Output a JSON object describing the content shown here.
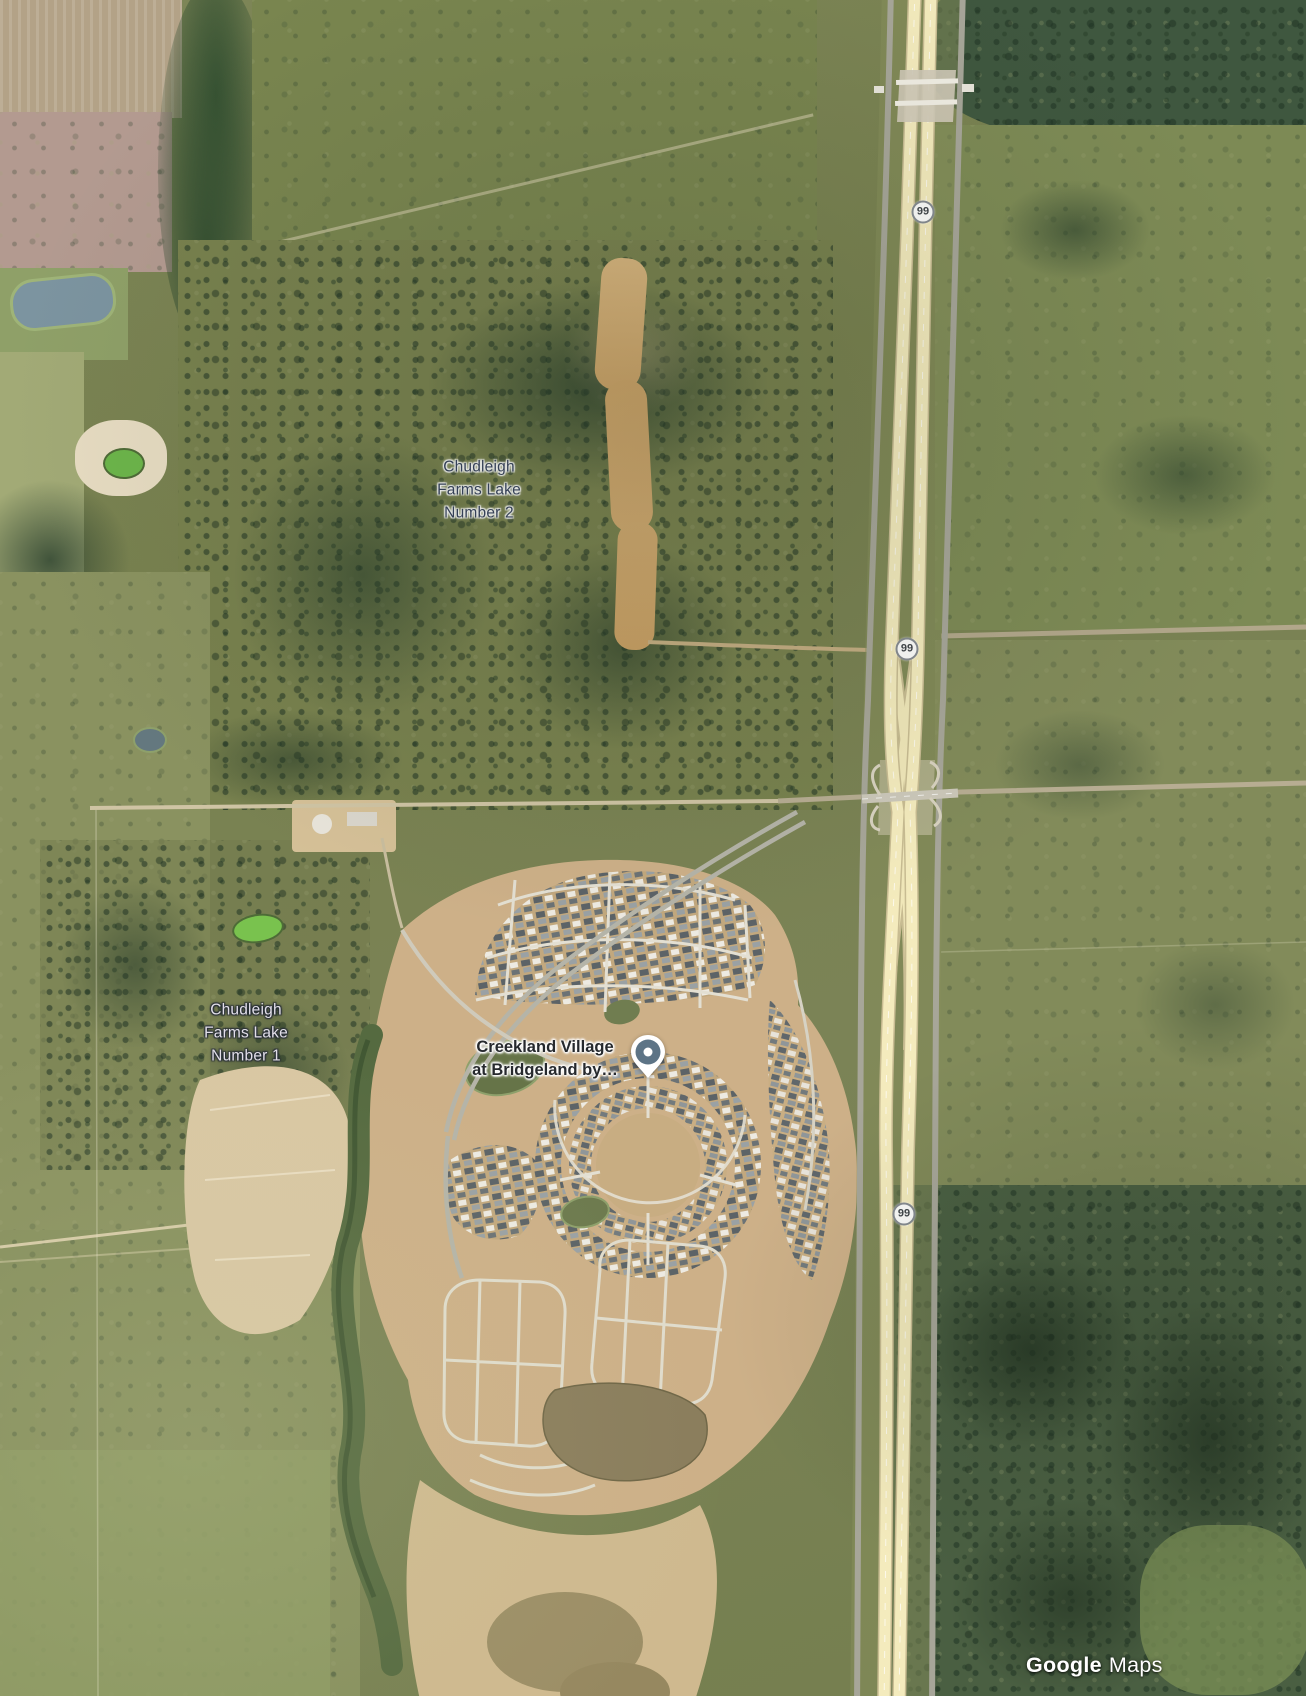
{
  "map": {
    "view": "satellite",
    "labels": {
      "lake2": {
        "lines": [
          "Chudleigh",
          "Farms Lake",
          "Number 2"
        ]
      },
      "lake1": {
        "lines": [
          "Chudleigh",
          "Farms Lake",
          "Number 1"
        ]
      },
      "poi": {
        "lines": [
          "Creekland Village",
          "at Bridgeland by…"
        ]
      }
    },
    "route_shields": [
      {
        "label": "99"
      },
      {
        "label": "99"
      },
      {
        "label": "99"
      }
    ],
    "watermark": {
      "brand": "Google",
      "product": "Maps"
    },
    "colors": {
      "poi_pin": "#5d7486",
      "shield_border": "#878c92",
      "water_label_dark": "#36425c",
      "water_label_light": "#e2dfe9",
      "highway_lanes": "#f4ebbd",
      "development_dirt": "#cdb088"
    }
  }
}
